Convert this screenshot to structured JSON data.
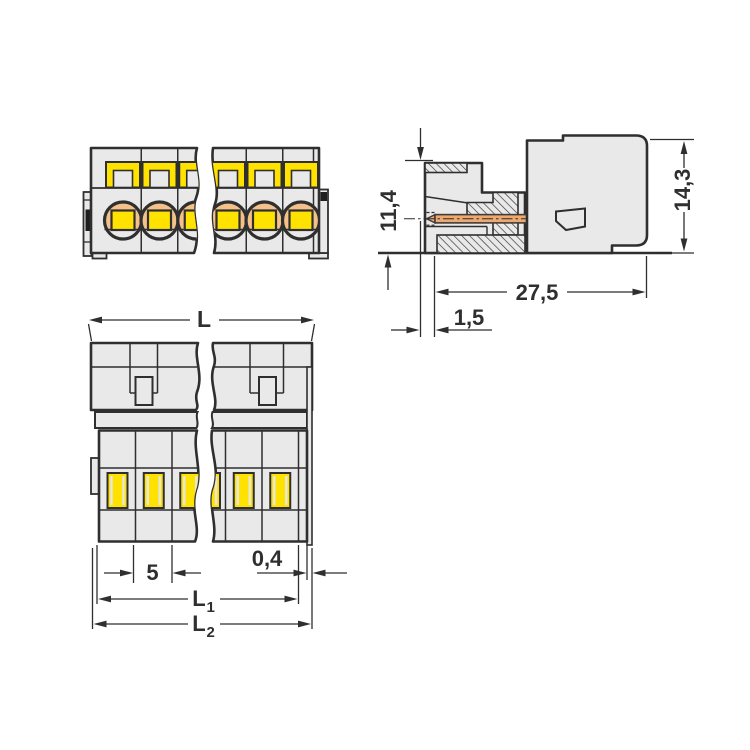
{
  "drawing": {
    "title": "pluggable-connector-dimension-drawing",
    "views": {
      "front": "front-view",
      "side": "side-section-view",
      "bottom": "bottom-view"
    },
    "dimensions": {
      "plug_height": "11,4",
      "housing_height": "14,3",
      "overall_depth": "27,5",
      "pin_setback": "1,5",
      "total_length": "L",
      "pin_spacing": "5",
      "wall_thickness": "0,4",
      "l1_base": "L",
      "l1_sub": "1",
      "l2_base": "L",
      "l2_sub": "2"
    },
    "colors": {
      "line": "#2f2f2f",
      "body": "#e9e9e9",
      "yellow": "#ffe200",
      "orange": "#f3c189",
      "pin": "#efa86d",
      "background": "#ffffff"
    }
  }
}
